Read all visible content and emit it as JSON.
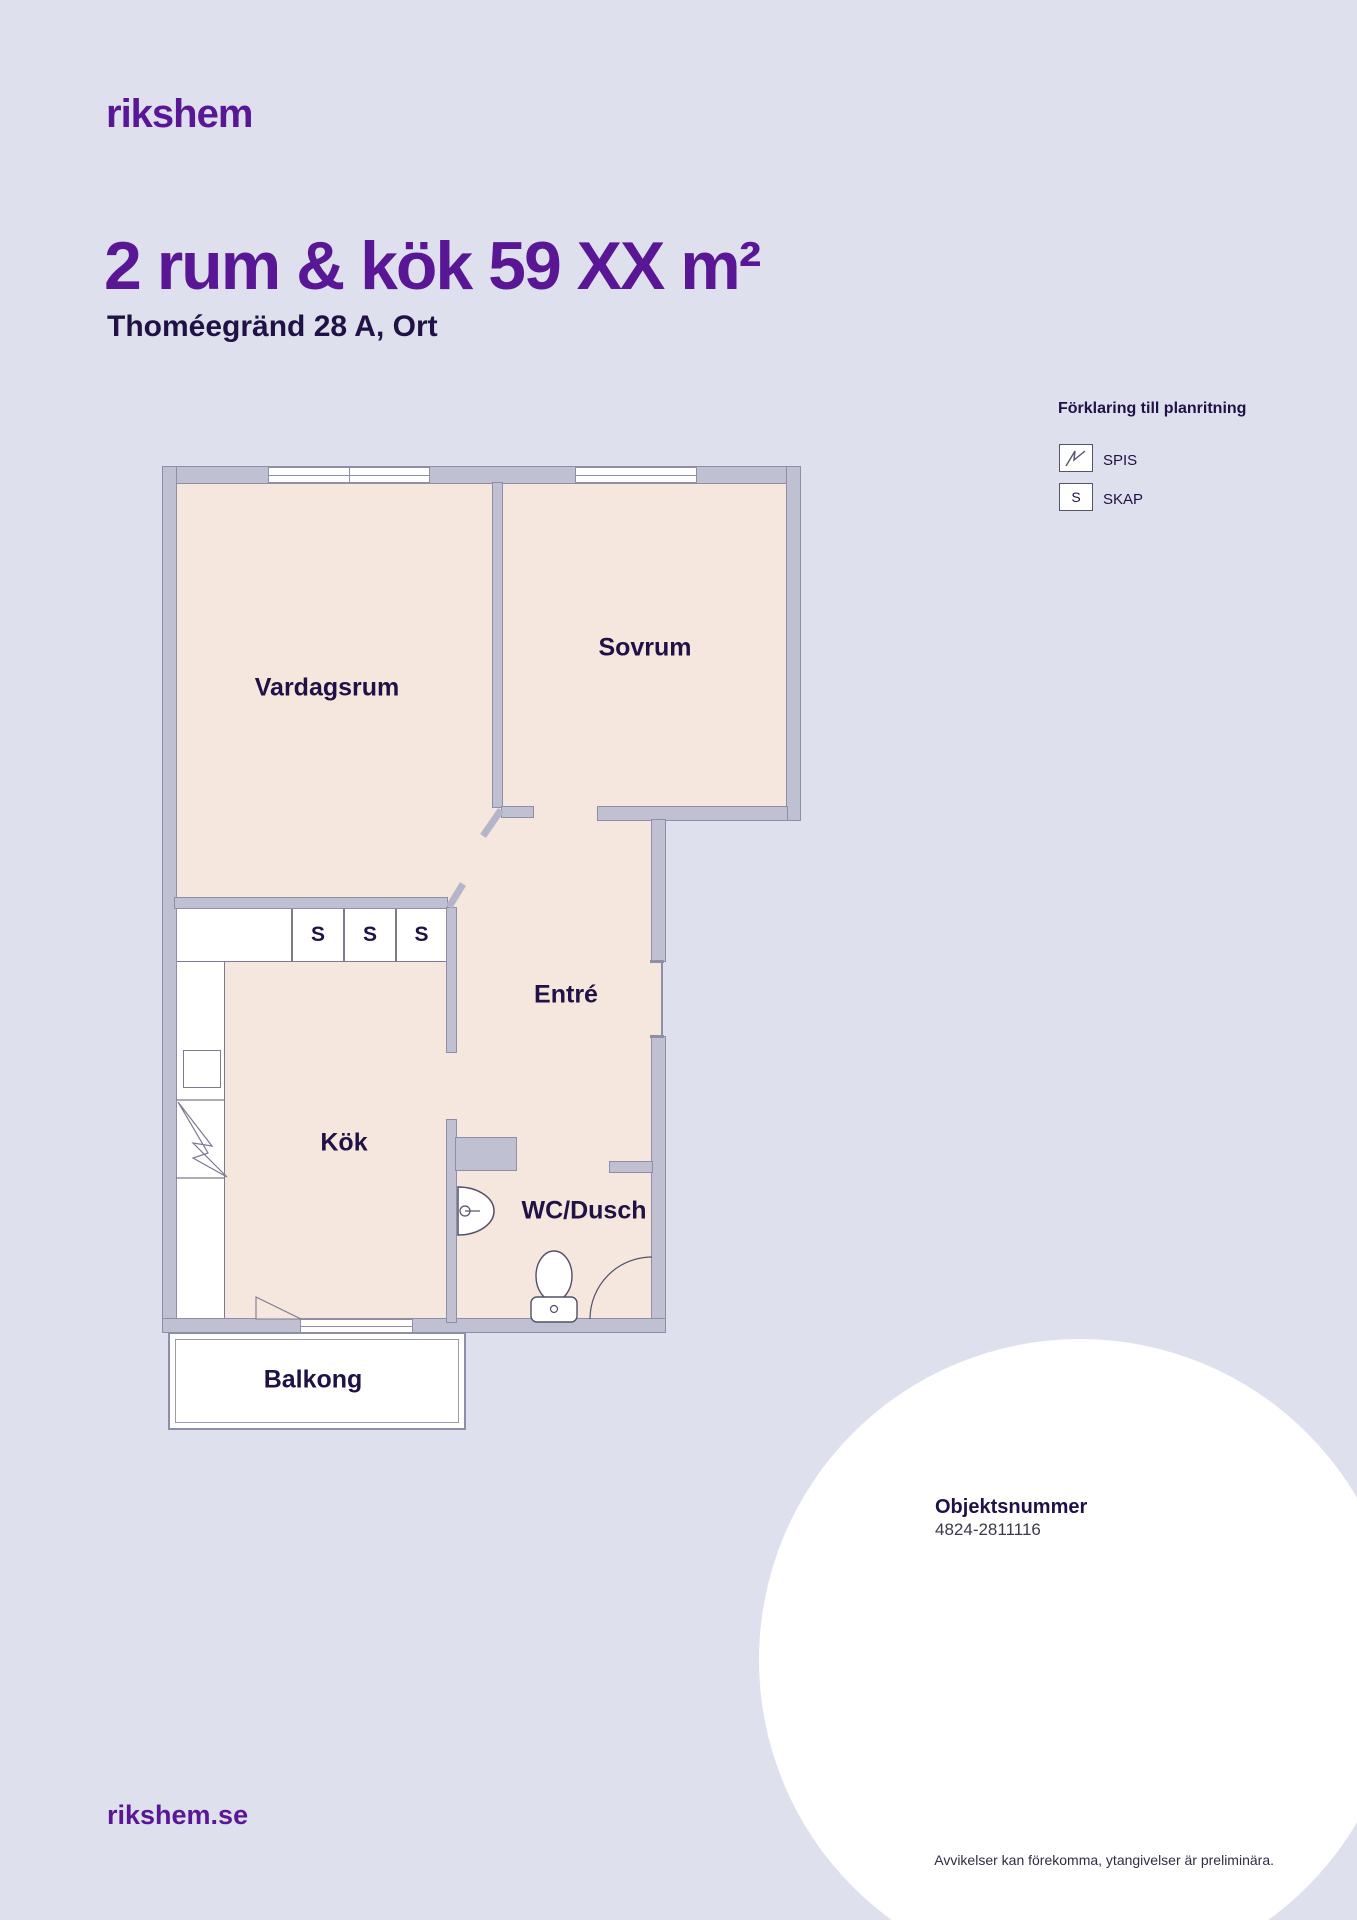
{
  "brand": {
    "logo_text": "rikshem",
    "website": "rikshem.se"
  },
  "header": {
    "title": "2 rum & kök 59 XX m²",
    "subtitle": "Thoméegränd 28 A, Ort"
  },
  "legend": {
    "heading": "Förklaring till planritning",
    "items": [
      {
        "id": "spis",
        "label": "SPIS"
      },
      {
        "id": "skap",
        "label": "SKAP",
        "symbol": "S"
      }
    ]
  },
  "floorplan": {
    "rooms": {
      "living": "Vardagsrum",
      "bedroom": "Sovrum",
      "entry": "Entré",
      "kitchen": "Kök",
      "bath": "WC/Dusch",
      "balcony": "Balkong"
    },
    "closet_letter": "S"
  },
  "footer": {
    "object_number_heading": "Objektsnummer",
    "object_number": "4824-2811116",
    "disclaimer": "Avvikelser kan förekomma, ytangivelser är preliminära."
  },
  "colors": {
    "brand_purple": "#5a1795",
    "text_navy": "#201245",
    "background_lavender": "#dee0ed",
    "floor_pink": "#f5e7de",
    "wall_gray": "#bfc0d2",
    "white": "#ffffff"
  }
}
